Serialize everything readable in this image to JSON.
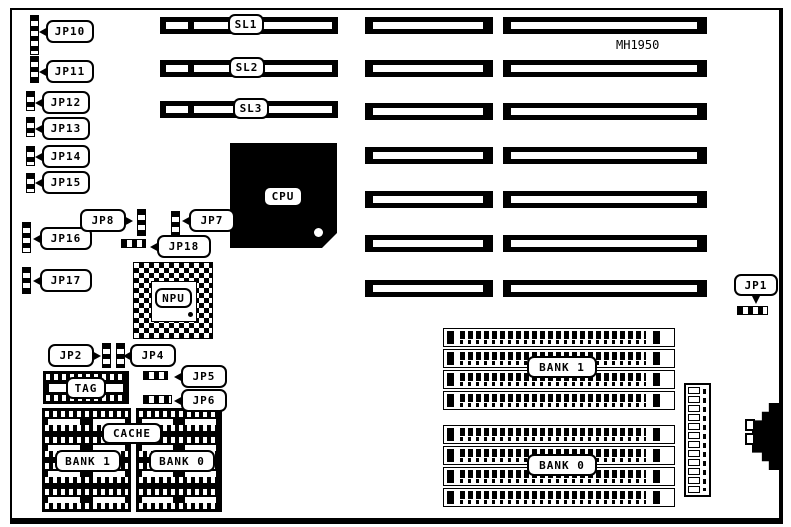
{
  "board": {
    "model": "MH1950"
  },
  "chips": {
    "cpu": "CPU",
    "npu": "NPU",
    "tag": "TAG",
    "cache": "CACHE",
    "cache_bank1": "BANK 1",
    "cache_bank0": "BANK 0"
  },
  "memory": {
    "bank1": "BANK 1",
    "bank0": "BANK 0"
  },
  "slots": {
    "sl1": "SL1",
    "sl2": "SL2",
    "sl3": "SL3"
  },
  "jumpers": {
    "jp1": "JP1",
    "jp2": "JP2",
    "jp4": "JP4",
    "jp5": "JP5",
    "jp6": "JP6",
    "jp7": "JP7",
    "jp8": "JP8",
    "jp10": "JP10",
    "jp11": "JP11",
    "jp12": "JP12",
    "jp13": "JP13",
    "jp14": "JP14",
    "jp15": "JP15",
    "jp16": "JP16",
    "jp17": "JP17",
    "jp18": "JP18"
  },
  "colors": {
    "ink": "#000000",
    "paper": "#ffffff"
  }
}
